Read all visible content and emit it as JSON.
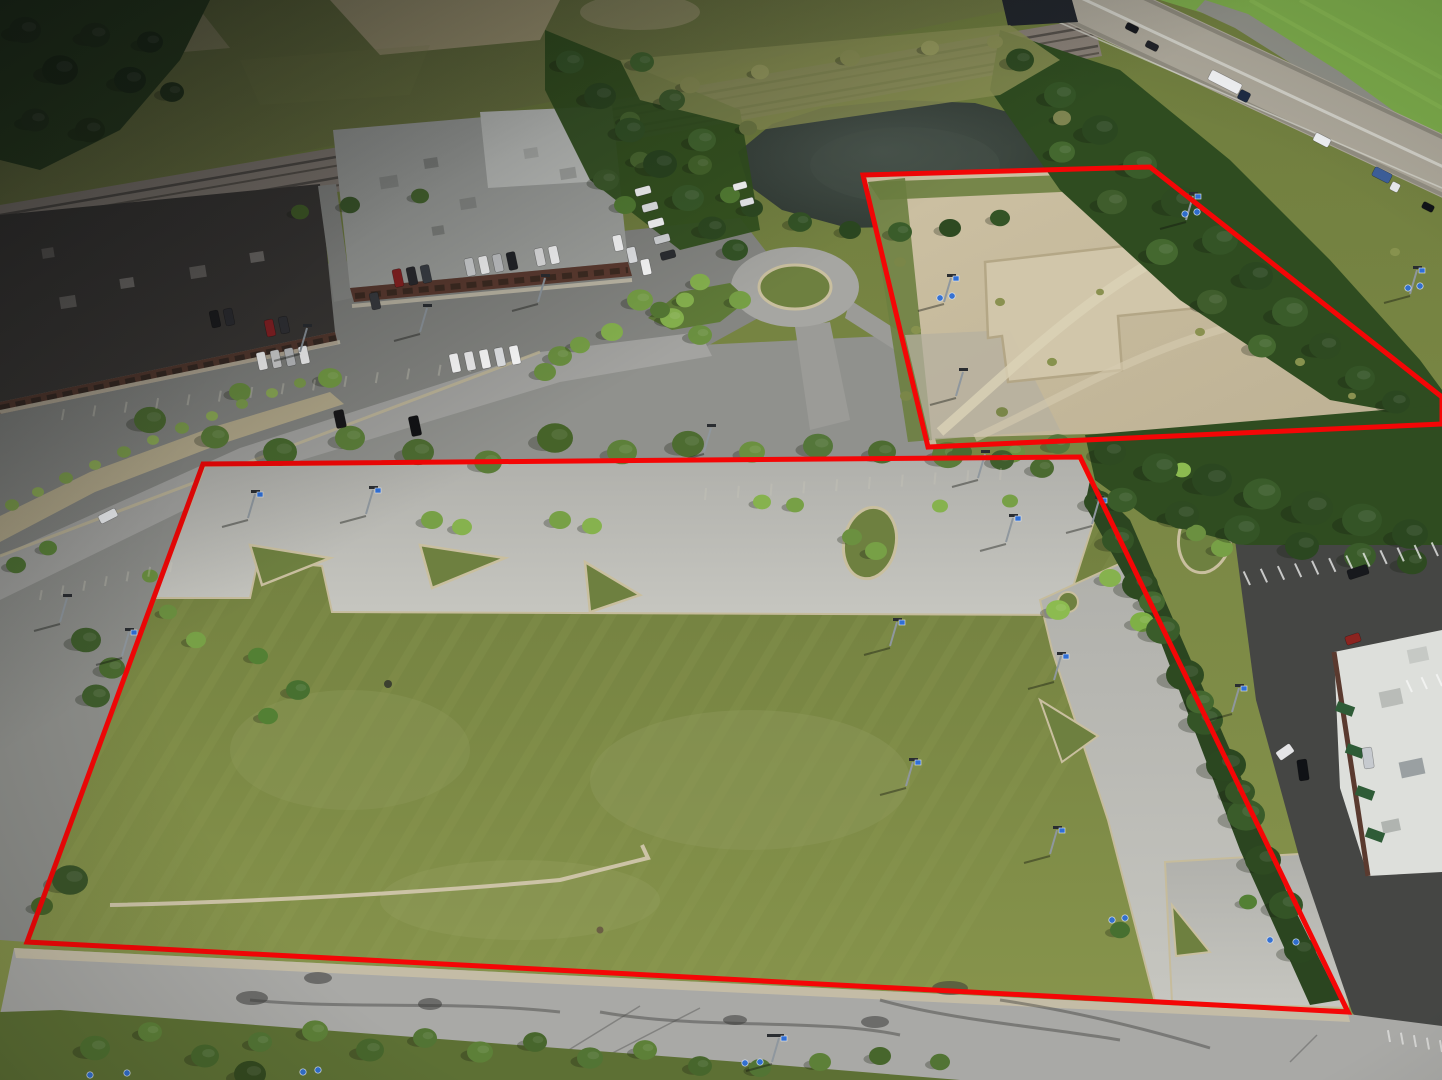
{
  "meta": {
    "description": "Aerial drone photograph of vacant commercial land with two parcels outlined in red; retail buildings, pond, railroad and highway in background",
    "photo_width": 1442,
    "photo_height": 1080
  },
  "palette": {
    "outline_red": "#f40606",
    "field_grass": "#77853f",
    "dirt_lot": "#c6ba9c",
    "old_pavement": "#8d8e8a",
    "parcel_pavement": "#b8b8b2",
    "dark_pavement": "#454644",
    "pond_water": "#39433d",
    "sign_blue": "#2f6fd6"
  },
  "outline": {
    "main": "203,464 1080,457 1348,1012 27,942",
    "rear": "863,175 1150,167 1442,397 1442,424 928,447",
    "width": 5
  },
  "stripes": {
    "n": 34,
    "x0": -320,
    "dx": 36,
    "run": 400,
    "ybot": 1090,
    "ytop": 420,
    "color": "#9aa65e",
    "opacity": 0.15,
    "width": 9
  },
  "trees": [
    [
      150,
      420,
      16,
      "#4d6c31"
    ],
    [
      215,
      437,
      14,
      "#5a7c38"
    ],
    [
      280,
      452,
      17,
      "#486a2e"
    ],
    [
      350,
      438,
      15,
      "#5d803a"
    ],
    [
      418,
      452,
      16,
      "#4d6c31"
    ],
    [
      488,
      462,
      14,
      "#5a7c38"
    ],
    [
      555,
      438,
      18,
      "#466329"
    ],
    [
      622,
      452,
      15,
      "#5d803a"
    ],
    [
      688,
      444,
      16,
      "#4d6c31"
    ],
    [
      752,
      452,
      13,
      "#6b9040"
    ],
    [
      818,
      446,
      15,
      "#54763a"
    ],
    [
      882,
      452,
      14,
      "#4d6c31"
    ],
    [
      948,
      455,
      16,
      "#5a7c38"
    ],
    [
      1012,
      452,
      13,
      "#6b9040"
    ],
    [
      1058,
      444,
      12,
      "#54763a"
    ],
    [
      240,
      392,
      11,
      "#6b9040"
    ],
    [
      330,
      378,
      12,
      "#77a046"
    ],
    [
      560,
      356,
      12,
      "#6b9040"
    ],
    [
      640,
      300,
      13,
      "#77a046"
    ],
    [
      672,
      318,
      12,
      "#86b24e"
    ],
    [
      700,
      335,
      12,
      "#6b9040"
    ],
    [
      612,
      332,
      11,
      "#86b24e"
    ],
    [
      580,
      345,
      10,
      "#77a046"
    ],
    [
      545,
      372,
      11,
      "#6b9040"
    ],
    [
      740,
      300,
      11,
      "#77a046"
    ],
    [
      700,
      282,
      10,
      "#86b24e"
    ],
    [
      660,
      310,
      10,
      "#557834"
    ],
    [
      685,
      300,
      9,
      "#86b24e"
    ],
    [
      640,
      160,
      10,
      "#4d6c31"
    ],
    [
      625,
      205,
      11,
      "#558034"
    ],
    [
      700,
      165,
      12,
      "#47682c"
    ],
    [
      730,
      195,
      10,
      "#558034"
    ],
    [
      630,
      120,
      10,
      "#4a6a30"
    ],
    [
      12,
      505,
      7,
      "#7fa04d"
    ],
    [
      38,
      492,
      6,
      "#8fae57"
    ],
    [
      66,
      478,
      7,
      "#7fa04d"
    ],
    [
      95,
      465,
      6,
      "#8fae57"
    ],
    [
      124,
      452,
      7,
      "#7fa04d"
    ],
    [
      153,
      440,
      6,
      "#8fae57"
    ],
    [
      182,
      428,
      7,
      "#7fa04d"
    ],
    [
      212,
      416,
      6,
      "#8fae57"
    ],
    [
      242,
      404,
      6,
      "#7fa04d"
    ],
    [
      272,
      393,
      6,
      "#8fae57"
    ],
    [
      300,
      383,
      6,
      "#7fa04d"
    ],
    [
      16,
      565,
      10,
      "#507434"
    ],
    [
      48,
      548,
      9,
      "#5d853a"
    ],
    [
      86,
      640,
      15,
      "#3f5d2c"
    ],
    [
      112,
      668,
      13,
      "#4a6a30"
    ],
    [
      96,
      696,
      14,
      "#3f5d2c"
    ],
    [
      70,
      880,
      18,
      "#3a5429"
    ],
    [
      42,
      906,
      11,
      "#466329"
    ],
    [
      150,
      576,
      8,
      "#6b9040"
    ],
    [
      258,
      656,
      10,
      "#538034"
    ],
    [
      298,
      690,
      12,
      "#477030"
    ],
    [
      268,
      716,
      10,
      "#538034"
    ],
    [
      432,
      520,
      11,
      "#77a046"
    ],
    [
      462,
      527,
      10,
      "#86b24e"
    ],
    [
      560,
      520,
      11,
      "#77a046"
    ],
    [
      592,
      526,
      10,
      "#86b24e"
    ],
    [
      852,
      537,
      10,
      "#6b9040"
    ],
    [
      876,
      551,
      11,
      "#77a046"
    ],
    [
      1196,
      533,
      10,
      "#6b9040"
    ],
    [
      1222,
      548,
      11,
      "#77a046"
    ],
    [
      762,
      502,
      9,
      "#86b24e"
    ],
    [
      795,
      505,
      9,
      "#77a046"
    ],
    [
      940,
      506,
      8,
      "#86b24e"
    ],
    [
      1010,
      501,
      8,
      "#77a046"
    ],
    [
      168,
      612,
      9,
      "#6b9040"
    ],
    [
      196,
      640,
      10,
      "#77a046"
    ],
    [
      1058,
      610,
      12,
      "#8cbb50"
    ],
    [
      1110,
      578,
      11,
      "#86b24e"
    ],
    [
      1142,
      622,
      12,
      "#7fb046"
    ],
    [
      1182,
      470,
      9,
      "#8cbb50"
    ],
    [
      1120,
      930,
      10,
      "#477030"
    ],
    [
      1248,
      902,
      9,
      "#538034"
    ],
    [
      1098,
      502,
      14,
      "#2e4a21"
    ],
    [
      1118,
      540,
      16,
      "#345426"
    ],
    [
      1140,
      585,
      18,
      "#2e4a21"
    ],
    [
      1163,
      630,
      17,
      "#3a5c2a"
    ],
    [
      1185,
      675,
      19,
      "#2e4a21"
    ],
    [
      1205,
      720,
      18,
      "#345426"
    ],
    [
      1226,
      765,
      20,
      "#2b4720"
    ],
    [
      1246,
      815,
      19,
      "#3a5c2a"
    ],
    [
      1263,
      860,
      18,
      "#2e4a21"
    ],
    [
      1286,
      905,
      17,
      "#345426"
    ],
    [
      1300,
      950,
      16,
      "#2b4720"
    ],
    [
      1152,
      602,
      13,
      "#44682f"
    ],
    [
      1200,
      702,
      14,
      "#44682f"
    ],
    [
      1240,
      792,
      15,
      "#365426"
    ],
    [
      1110,
      452,
      16,
      "#2e4a21"
    ],
    [
      1160,
      468,
      18,
      "#345426"
    ],
    [
      1212,
      480,
      20,
      "#2b4720"
    ],
    [
      1262,
      494,
      19,
      "#3a5c2a"
    ],
    [
      1312,
      508,
      21,
      "#2e4a21"
    ],
    [
      1362,
      520,
      20,
      "#345426"
    ],
    [
      1410,
      534,
      18,
      "#2b4720"
    ],
    [
      1122,
      500,
      15,
      "#3a5c2a"
    ],
    [
      1182,
      515,
      17,
      "#2e4a21"
    ],
    [
      1242,
      530,
      18,
      "#345426"
    ],
    [
      1302,
      546,
      17,
      "#2b4720"
    ],
    [
      1360,
      556,
      16,
      "#3a5c2a"
    ],
    [
      1412,
      562,
      15,
      "#2e4a21"
    ],
    [
      962,
      452,
      10,
      "#4a6a30"
    ],
    [
      1002,
      460,
      12,
      "#3f5d2c"
    ],
    [
      1042,
      468,
      12,
      "#4a6a30"
    ],
    [
      1020,
      60,
      14,
      "#2e4a21"
    ],
    [
      1060,
      95,
      16,
      "#345426"
    ],
    [
      1100,
      130,
      18,
      "#2b4720"
    ],
    [
      1140,
      165,
      17,
      "#3a5c2a"
    ],
    [
      1180,
      202,
      19,
      "#2e4a21"
    ],
    [
      1220,
      240,
      18,
      "#345426"
    ],
    [
      1256,
      276,
      17,
      "#2b4720"
    ],
    [
      1290,
      312,
      18,
      "#3a5c2a"
    ],
    [
      1325,
      346,
      16,
      "#2e4a21"
    ],
    [
      1360,
      378,
      15,
      "#345426"
    ],
    [
      1396,
      402,
      14,
      "#2b4720"
    ],
    [
      1062,
      152,
      13,
      "#44682f"
    ],
    [
      1112,
      202,
      15,
      "#3f5d2c"
    ],
    [
      1162,
      252,
      16,
      "#44682f"
    ],
    [
      1212,
      302,
      15,
      "#3f5d2c"
    ],
    [
      1262,
      346,
      14,
      "#44682f"
    ],
    [
      570,
      62,
      14,
      "#3a5c2a"
    ],
    [
      600,
      96,
      16,
      "#2e4a21"
    ],
    [
      630,
      130,
      15,
      "#345426"
    ],
    [
      660,
      164,
      17,
      "#2b4720"
    ],
    [
      688,
      198,
      16,
      "#3a5c2a"
    ],
    [
      712,
      228,
      14,
      "#2e4a21"
    ],
    [
      642,
      62,
      12,
      "#44682f"
    ],
    [
      672,
      100,
      13,
      "#3f5d2c"
    ],
    [
      702,
      140,
      14,
      "#44682f"
    ],
    [
      606,
      180,
      13,
      "#3f5d2c"
    ],
    [
      735,
      250,
      13,
      "#345426"
    ],
    [
      25,
      30,
      16,
      "#26381c"
    ],
    [
      60,
      70,
      18,
      "#1f3018"
    ],
    [
      95,
      35,
      15,
      "#26381c"
    ],
    [
      130,
      80,
      16,
      "#1f3018"
    ],
    [
      35,
      120,
      14,
      "#26381c"
    ],
    [
      90,
      130,
      15,
      "#243619"
    ],
    [
      150,
      42,
      13,
      "#1f3018"
    ],
    [
      172,
      92,
      12,
      "#26381c"
    ],
    [
      95,
      1048,
      15,
      "#4f7030"
    ],
    [
      150,
      1032,
      12,
      "#5d8038"
    ],
    [
      205,
      1056,
      14,
      "#47662c"
    ],
    [
      260,
      1042,
      12,
      "#527434"
    ],
    [
      315,
      1031,
      13,
      "#5d8038"
    ],
    [
      370,
      1050,
      14,
      "#47662c"
    ],
    [
      425,
      1038,
      12,
      "#527434"
    ],
    [
      480,
      1052,
      13,
      "#5d8038"
    ],
    [
      535,
      1042,
      12,
      "#47662c"
    ],
    [
      590,
      1058,
      13,
      "#527434"
    ],
    [
      645,
      1050,
      12,
      "#5d8038"
    ],
    [
      700,
      1066,
      12,
      "#47662c"
    ],
    [
      250,
      1074,
      16,
      "#33491f"
    ],
    [
      760,
      1068,
      11,
      "#527434"
    ],
    [
      820,
      1062,
      11,
      "#5d8038"
    ],
    [
      880,
      1056,
      11,
      "#47662c"
    ],
    [
      940,
      1062,
      10,
      "#527434"
    ],
    [
      690,
      85,
      10,
      "#8a8f54"
    ],
    [
      760,
      72,
      9,
      "#979b5e"
    ],
    [
      850,
      58,
      10,
      "#8a8f54"
    ],
    [
      930,
      48,
      9,
      "#979b5e"
    ],
    [
      995,
      42,
      8,
      "#8a8f54"
    ],
    [
      1062,
      118,
      9,
      "#7e8450"
    ],
    [
      748,
      128,
      9,
      "#6f7a44"
    ],
    [
      900,
      262,
      6,
      "#7a8648"
    ],
    [
      916,
      330,
      5,
      "#87924e"
    ],
    [
      906,
      396,
      6,
      "#7a8648"
    ],
    [
      1000,
      302,
      5,
      "#8a9150"
    ],
    [
      1100,
      292,
      4,
      "#8a9150"
    ],
    [
      1052,
      362,
      5,
      "#87924e"
    ],
    [
      1002,
      412,
      6,
      "#7a8648"
    ],
    [
      1200,
      332,
      5,
      "#8a9150"
    ],
    [
      1300,
      362,
      5,
      "#87924e"
    ],
    [
      1352,
      396,
      4,
      "#8a9150"
    ],
    [
      1395,
      252,
      5,
      "#87924e"
    ],
    [
      350,
      205,
      10,
      "#3f5d2c"
    ],
    [
      420,
      196,
      9,
      "#4a6a30"
    ],
    [
      300,
      212,
      9,
      "#466329"
    ],
    [
      752,
      208,
      11,
      "#2e4a21"
    ],
    [
      800,
      222,
      12,
      "#345426"
    ],
    [
      850,
      230,
      11,
      "#2b4720"
    ],
    [
      900,
      232,
      12,
      "#3a5c2a"
    ],
    [
      950,
      228,
      11,
      "#2e4a21"
    ],
    [
      1000,
      218,
      10,
      "#345426"
    ]
  ],
  "cars": [
    [
      398,
      278,
      9,
      18,
      -12,
      "#8e2222"
    ],
    [
      412,
      276,
      9,
      18,
      -12,
      "#2a2a2e"
    ],
    [
      426,
      274,
      9,
      18,
      -12,
      "#3c4046"
    ],
    [
      470,
      267,
      9,
      18,
      -12,
      "#d8dadb"
    ],
    [
      484,
      265,
      9,
      18,
      -12,
      "#ffffff"
    ],
    [
      498,
      263,
      9,
      18,
      -12,
      "#caccce"
    ],
    [
      512,
      261,
      9,
      18,
      -12,
      "#222428"
    ],
    [
      540,
      257,
      9,
      18,
      -12,
      "#e8e8e8"
    ],
    [
      554,
      255,
      9,
      18,
      -12,
      "#ffffff"
    ],
    [
      215,
      319,
      9,
      17,
      -12,
      "#1c1c1e"
    ],
    [
      229,
      317,
      9,
      17,
      -12,
      "#2e2e32"
    ],
    [
      270,
      328,
      9,
      17,
      -12,
      "#8c2124"
    ],
    [
      284,
      325,
      9,
      17,
      -12,
      "#323236"
    ],
    [
      262,
      361,
      9,
      18,
      -12,
      "#ffffff"
    ],
    [
      276,
      359,
      9,
      18,
      -12,
      "#d9d9d9"
    ],
    [
      290,
      357,
      9,
      18,
      -12,
      "#c4c6c8"
    ],
    [
      304,
      355,
      9,
      18,
      -12,
      "#ffffff"
    ],
    [
      375,
      301,
      9,
      17,
      -12,
      "#3a3c40"
    ],
    [
      455,
      363,
      9,
      19,
      -12,
      "#ffffff"
    ],
    [
      470,
      361,
      9,
      19,
      -12,
      "#f2f2f2"
    ],
    [
      485,
      359,
      9,
      19,
      -12,
      "#ffffff"
    ],
    [
      500,
      357,
      9,
      19,
      -12,
      "#e6e8ea"
    ],
    [
      515,
      355,
      9,
      19,
      -12,
      "#ffffff"
    ],
    [
      340,
      419,
      10,
      18,
      -12,
      "#18181a"
    ],
    [
      415,
      426,
      10,
      20,
      -12,
      "#121214"
    ],
    [
      643,
      191,
      16,
      8,
      -15,
      "#ffffff"
    ],
    [
      650,
      207,
      16,
      8,
      -15,
      "#eceeef"
    ],
    [
      656,
      223,
      16,
      8,
      -15,
      "#ffffff"
    ],
    [
      662,
      239,
      16,
      8,
      -15,
      "#d8dadc"
    ],
    [
      668,
      255,
      15,
      8,
      -15,
      "#2c2e32"
    ],
    [
      618,
      243,
      9,
      16,
      -12,
      "#ffffff"
    ],
    [
      632,
      255,
      9,
      16,
      -12,
      "#e8eaec"
    ],
    [
      646,
      267,
      9,
      16,
      -12,
      "#ffffff"
    ],
    [
      740,
      186,
      14,
      7,
      -15,
      "#ffffff"
    ],
    [
      747,
      202,
      14,
      7,
      -15,
      "#f0f2f4"
    ],
    [
      1132,
      28,
      13,
      7,
      27,
      "#17191f"
    ],
    [
      1152,
      46,
      13,
      7,
      27,
      "#22242a"
    ],
    [
      1225,
      82,
      34,
      11,
      27,
      "#f2f3f5"
    ],
    [
      1244,
      96,
      11,
      10,
      27,
      "#1e2c44"
    ],
    [
      1322,
      140,
      17,
      9,
      27,
      "#eef0f2"
    ],
    [
      1382,
      175,
      19,
      10,
      27,
      "#3d5f9a"
    ],
    [
      1395,
      187,
      9,
      9,
      27,
      "#e8eaec"
    ],
    [
      1428,
      207,
      12,
      7,
      27,
      "#101318"
    ],
    [
      1358,
      572,
      21,
      10,
      -18,
      "#17191d"
    ],
    [
      1368,
      758,
      10,
      21,
      -8,
      "#c6cacf"
    ],
    [
      1303,
      770,
      10,
      21,
      -8,
      "#101216"
    ],
    [
      1285,
      752,
      17,
      10,
      -35,
      "#e4e4e6"
    ],
    [
      1353,
      639,
      15,
      9,
      -18,
      "#8c2420"
    ],
    [
      108,
      516,
      19,
      9,
      -27,
      "#f5f7f9"
    ]
  ],
  "poles": [
    [
      248,
      518,
      1
    ],
    [
      366,
      514,
      1
    ],
    [
      978,
      478,
      0
    ],
    [
      1006,
      542,
      1
    ],
    [
      890,
      646,
      1
    ],
    [
      1054,
      680,
      1
    ],
    [
      906,
      786,
      1
    ],
    [
      1050,
      854,
      1
    ],
    [
      122,
      656,
      1
    ],
    [
      944,
      302,
      1
    ],
    [
      1186,
      220,
      1
    ],
    [
      1410,
      294,
      1
    ],
    [
      956,
      396,
      0
    ],
    [
      1232,
      712,
      1
    ],
    [
      772,
      1062,
      2
    ],
    [
      538,
      302,
      0
    ],
    [
      704,
      452,
      0
    ],
    [
      1092,
      524,
      1
    ],
    [
      60,
      622,
      0
    ],
    [
      420,
      332,
      0
    ],
    [
      300,
      352,
      0
    ]
  ],
  "stalls": [
    [
      1250,
      585,
      1438,
      556,
      12,
      15,
      115,
      "#ffffff",
      0.7
    ],
    [
      1412,
      692,
      1442,
      686,
      3,
      13,
      115,
      "#ffffff",
      0.6
    ],
    [
      1390,
      1042,
      1442,
      1052,
      5,
      12,
      100,
      "#ffffff",
      0.5
    ],
    [
      62,
      420,
      470,
      372,
      14,
      11,
      80,
      "#eae6d4",
      0.3
    ],
    [
      40,
      600,
      170,
      572,
      7,
      10,
      80,
      "#d8d4c4",
      0.3
    ],
    [
      705,
      500,
      1000,
      480,
      10,
      12,
      85,
      "#d0cdbd",
      0.25
    ]
  ],
  "dots": [
    [
      90,
      1075
    ],
    [
      127,
      1073
    ],
    [
      303,
      1072
    ],
    [
      318,
      1070
    ],
    [
      745,
      1063
    ],
    [
      760,
      1062
    ],
    [
      1112,
      920
    ],
    [
      1125,
      918
    ],
    [
      1270,
      940
    ],
    [
      1296,
      942
    ],
    [
      940,
      298
    ],
    [
      952,
      296
    ],
    [
      1185,
      214
    ],
    [
      1197,
      212
    ],
    [
      1408,
      288
    ],
    [
      1420,
      286
    ]
  ]
}
